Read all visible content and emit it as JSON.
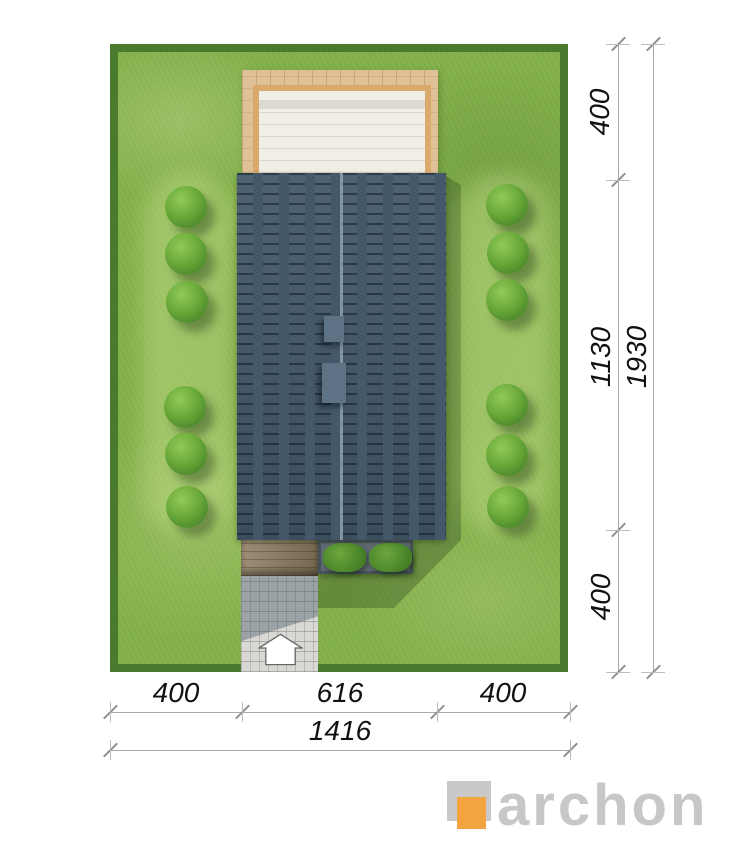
{
  "plan": {
    "dimensions": {
      "right_segments": [
        "400",
        "1130",
        "400"
      ],
      "right_total": "1930",
      "bottom_segments": [
        "400",
        "616",
        "400"
      ],
      "bottom_total": "1416"
    },
    "logo": {
      "text": "archon"
    },
    "icons": {
      "entrance_arrow": "house-shaped-up-arrow"
    },
    "colors": {
      "lawn": "#84B24C",
      "hedge": "#4A7A2E",
      "roof": "#44586A",
      "roof_ridge": "#8FA0AE",
      "chimney": "#5D7284",
      "terrace_wood": "#E0C197",
      "terrace_frame": "#D9AA6C",
      "terrace_inner": "#F1EEE5",
      "entry_wood": "#8D7C60",
      "paving": "#D9D8D4",
      "planter_frame": "#47525B",
      "bush_green": "#4F8A2C",
      "tree_green": "#6AAA3A",
      "logo_orange": "#F3A440",
      "logo_grey": "#C7C7C7",
      "dimension_line": "#A9A9A9",
      "dimension_text": "#111111"
    }
  }
}
